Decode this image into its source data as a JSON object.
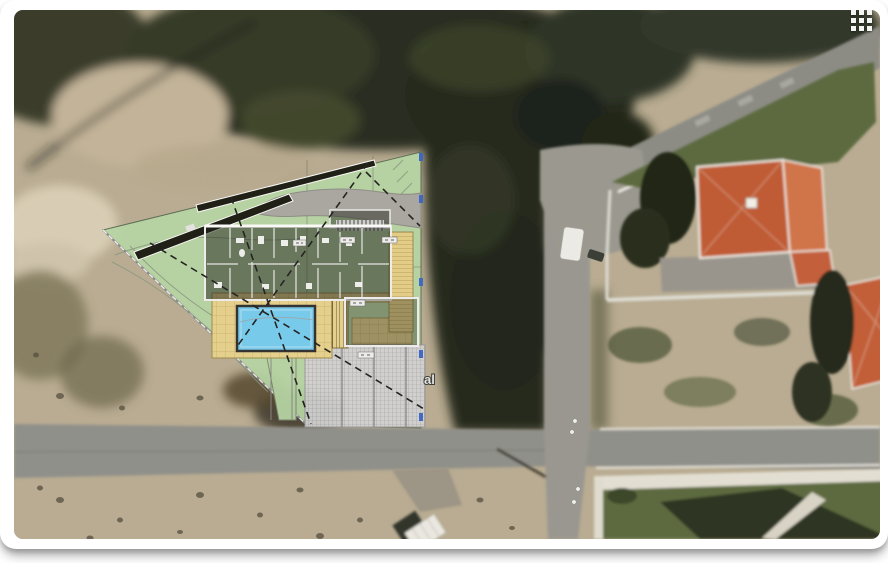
{
  "icons": {
    "apps_grid": "grid-3x3"
  },
  "labels": {
    "street_fragment": "al"
  },
  "colors": {
    "sand": "#b9ac92",
    "trees_dark": "#2a2f20",
    "road_gray": "#90908a",
    "road_gray_light": "#99978f",
    "lawn_green": "#5d6a40",
    "roof_orange": "#c05c36",
    "roof_orange_light": "#d0744a",
    "site_green": "#b7d5a4",
    "deck_yellow": "#e9d28d",
    "pool_blue": "#74cdf2",
    "paving_gray": "#d3d3d3",
    "tick_blue": "#3a66c8",
    "frame_white": "#ffffff"
  },
  "overlay": {
    "features": [
      {
        "name": "site-boundary",
        "color_key": "site_green"
      },
      {
        "name": "building-floor-plan",
        "color_key": "frame_white"
      },
      {
        "name": "swimming-pool",
        "color_key": "pool_blue"
      },
      {
        "name": "timber-deck",
        "color_key": "deck_yellow"
      },
      {
        "name": "paved-patio",
        "color_key": "paving_gray"
      },
      {
        "name": "driveway-strips",
        "color_key": "trees_dark"
      },
      {
        "name": "survey-ticks",
        "color_key": "tick_blue"
      }
    ]
  }
}
